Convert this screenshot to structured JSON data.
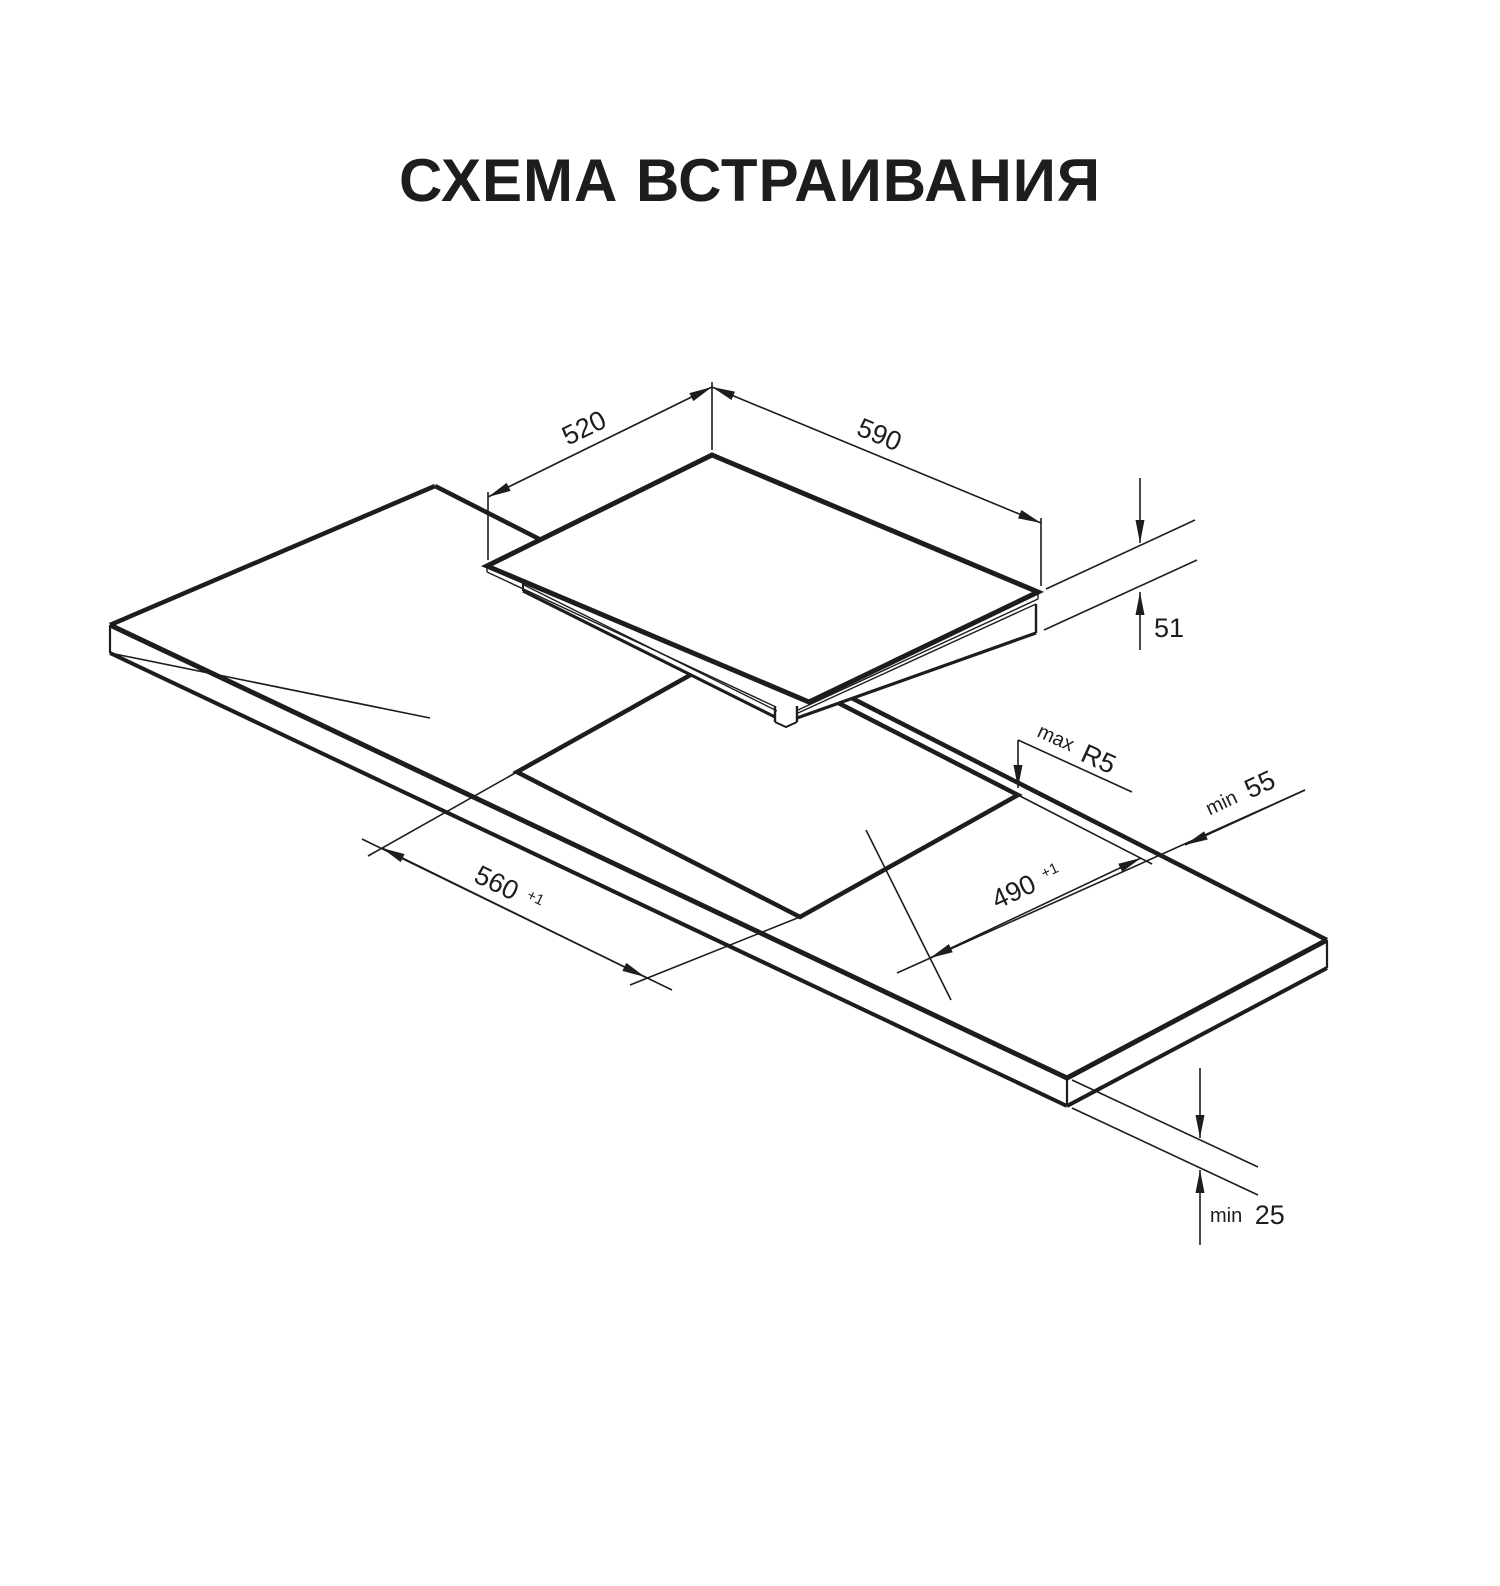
{
  "title": "СХЕМА ВСТРАИВАНИЯ",
  "diagram": {
    "kind": "built-in hob installation cutout scheme",
    "hob": {
      "top_depth_mm": "520",
      "top_width_mm": "590",
      "body_height_mm": "51"
    },
    "cutout": {
      "length_mm": "560",
      "length_tolerance": "+1",
      "depth_mm": "490",
      "depth_tolerance": "+1",
      "corner_radius_max": "R5",
      "rear_edge_distance_min_mm": "55",
      "clearance_below_min_mm": "25"
    }
  },
  "labels": {
    "d520": "520",
    "d590": "590",
    "d51": "51",
    "max_prefix": "max",
    "r5": "R5",
    "min_prefix_55": "min",
    "d55": "55",
    "d560": "560",
    "tol_560": "+1",
    "d490": "490",
    "tol_490": "+1",
    "min_prefix_25": "min",
    "d25": "25"
  }
}
